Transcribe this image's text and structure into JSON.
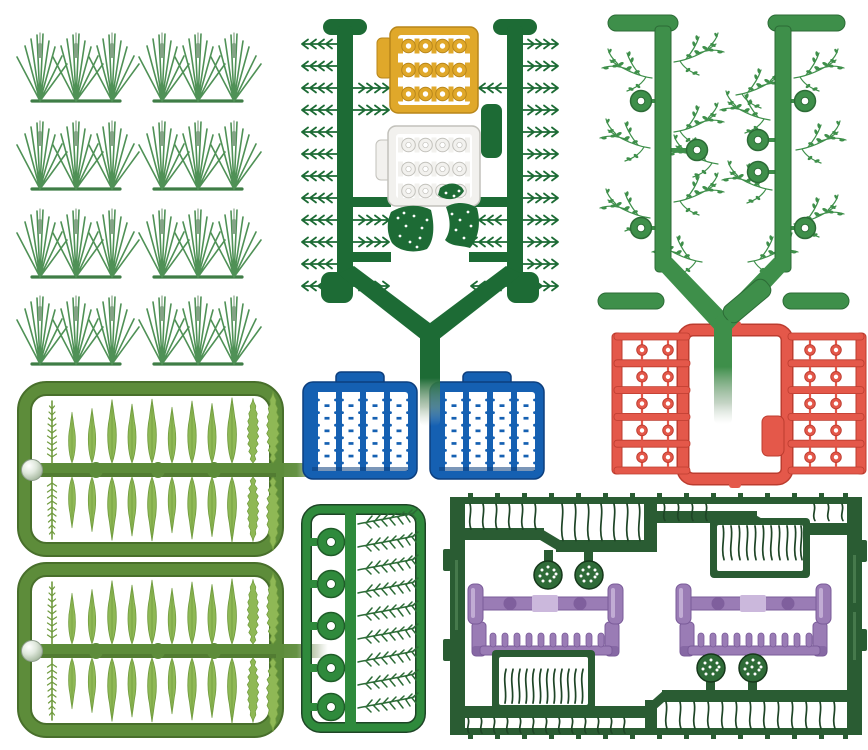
{
  "canvas": {
    "width": 868,
    "height": 750
  },
  "colors": {
    "background": "#ffffff",
    "sprue_dark_green": "#1d6b35",
    "panel_green": "#2a5c33",
    "panel_edge": "#1e4526",
    "mid_green": "#3e8f4a",
    "mid_green_dark": "#2c6b36",
    "grass_green": "#4f9156",
    "grass_base": "#3f7d46",
    "cattail_gray": "#85a387",
    "olive": "#5d8c3a",
    "olive_dark": "#486f2b",
    "leaf_light": "#8fb855",
    "leaf_edge": "#6f9a3d",
    "yellow": "#e0a82a",
    "yellow_dark": "#b8861a",
    "white_sprue": "#f2f1ee",
    "white_sprue_edge": "#c2c1bb",
    "blue": "#1560b2",
    "blue_dark": "#0d3f7e",
    "red": "#e4584a",
    "red_dark": "#bc3c2f",
    "purple": "#9a7cb5",
    "purple_light": "#cbb8dc",
    "purple_dark": "#7a5b99"
  },
  "sprues": [
    {
      "name": "grass-tuft-strips",
      "color_key": "grass_green",
      "strips": 8,
      "tufts_per_strip": 3
    },
    {
      "name": "fern-rail-sprue",
      "color_key": "sprue_dark_green",
      "fern_sprigs_per_rail": 12,
      "flower_panels": [
        "yellow",
        "white"
      ],
      "dotted_leaf_pieces": 2
    },
    {
      "name": "wispy-plant-sprue",
      "color_key": "mid_green",
      "round_flowers": 7
    },
    {
      "name": "red-flower-ladder-sprue",
      "color_key": "red",
      "ladders": 2,
      "cells_per_ladder": 5,
      "flowers_per_cell": 2
    },
    {
      "name": "olive-leaf-frames",
      "color_key": "olive",
      "frames": 2,
      "leaves_per_row": 12,
      "rows_per_frame": 2
    },
    {
      "name": "blue-flower-panels",
      "color_key": "blue",
      "panels": 2,
      "flower_columns": 4,
      "flowers_per_column": 6
    },
    {
      "name": "round-flower-fir-sprue",
      "color_key": "mid_green",
      "round_flowers": 5,
      "fir_sprigs": 9
    },
    {
      "name": "large-grass-panel",
      "color_key": "panel_green",
      "purple_combs": 2,
      "dotted_seed_discs": 4,
      "grass_boxes": 2
    }
  ]
}
